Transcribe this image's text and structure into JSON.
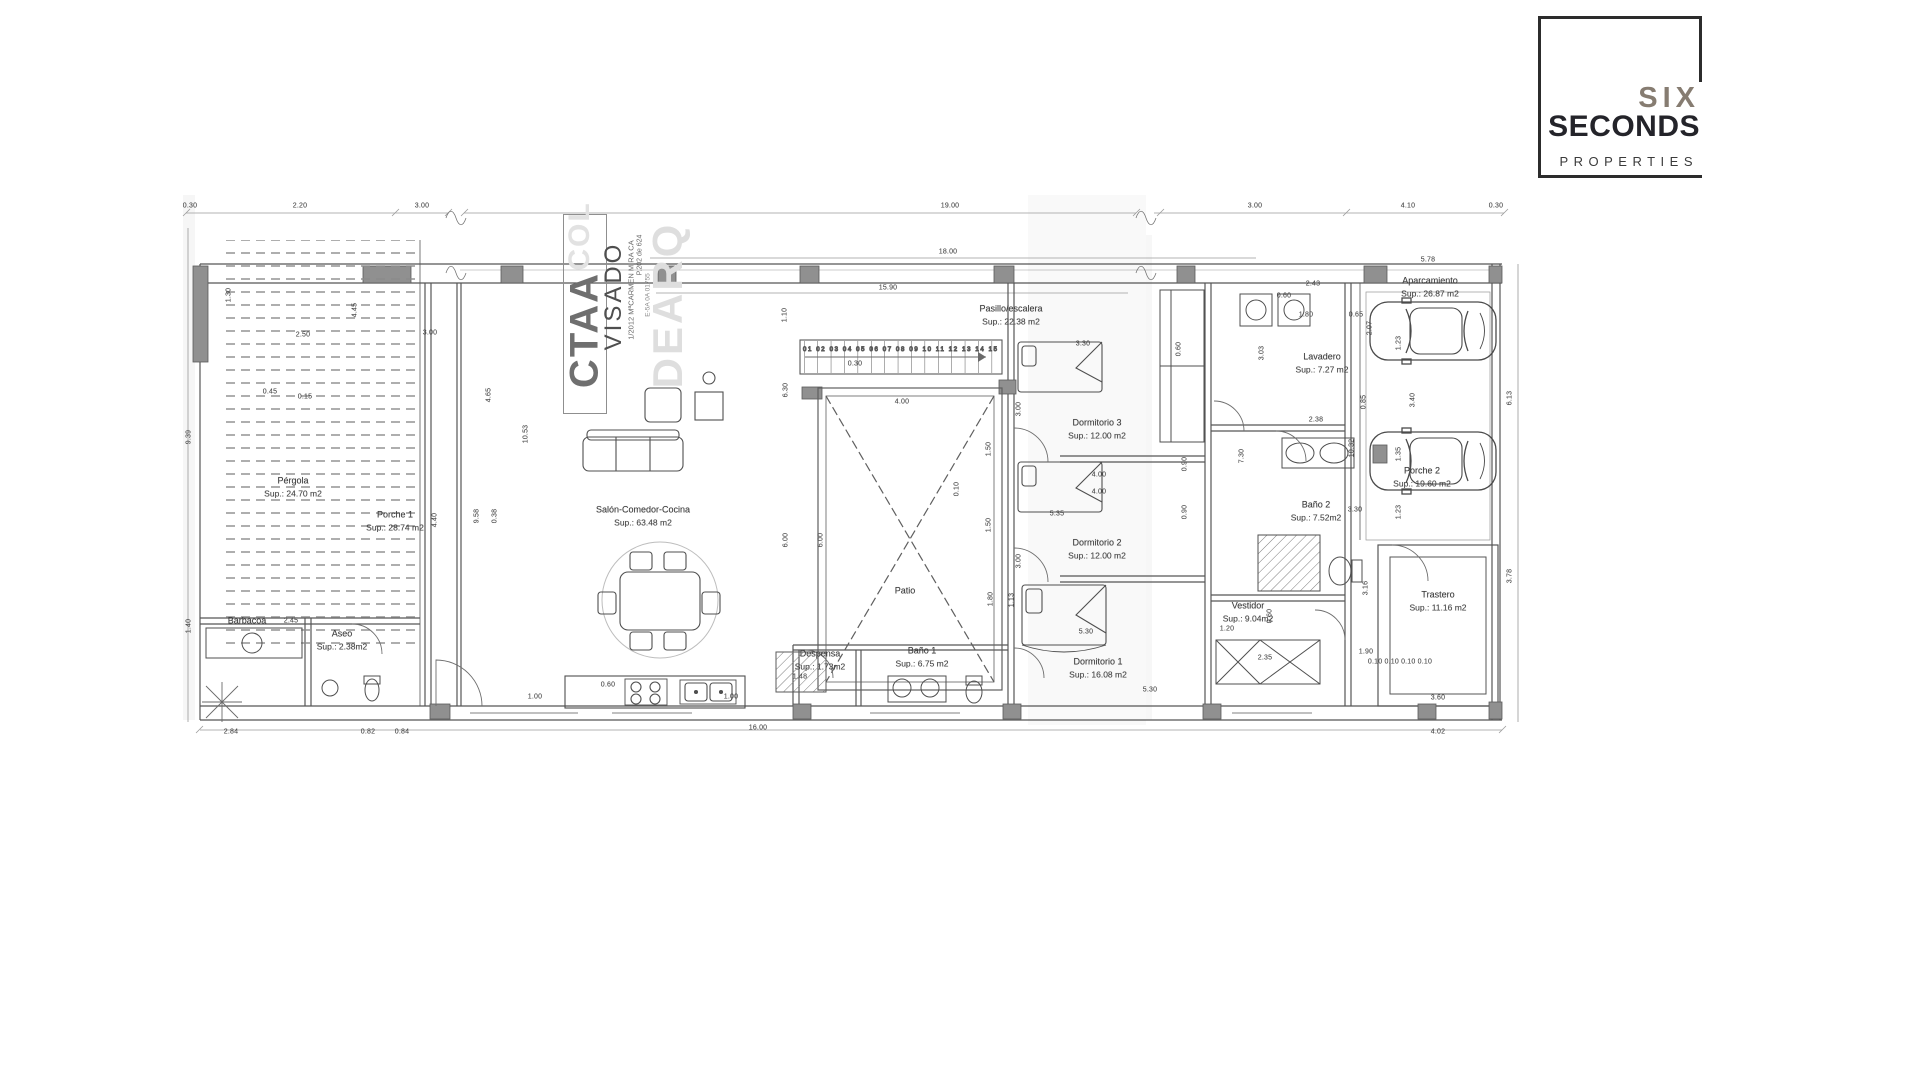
{
  "logo": {
    "six": "SIX",
    "seconds": "SECONDS",
    "properties": "PROPERTIES"
  },
  "stamp": {
    "org": "CTAA",
    "status": "VISADO",
    "small1": "1/2012 MªCARMEN MIRA CA",
    "small2": "P.202 de 624",
    "small3": "E-5A 0A 01755",
    "wm1": "COL",
    "wm2": "DEARQ"
  },
  "stairs": {
    "treads": "01 02 03 04 05 06 07 08 09 10 11 12 13 14 15"
  },
  "rooms": [
    {
      "n": "Pérgola",
      "a": "Sup.: 24.70 m2",
      "x": 293,
      "y": 487
    },
    {
      "n": "Porche 1",
      "a": "Sup.: 28.74 m2",
      "x": 395,
      "y": 521
    },
    {
      "n": "Salón-Comedor-Cocina",
      "a": "Sup.: 63.48 m2",
      "x": 643,
      "y": 516
    },
    {
      "n": "Patio",
      "a": "",
      "x": 905,
      "y": 591
    },
    {
      "n": "Pasillo/escalera",
      "a": "Sup.: 22.38 m2",
      "x": 1011,
      "y": 315
    },
    {
      "n": "Dormitorio 3",
      "a": "Sup.: 12.00 m2",
      "x": 1097,
      "y": 429
    },
    {
      "n": "Dormitorio 2",
      "a": "Sup.: 12.00 m2",
      "x": 1097,
      "y": 549
    },
    {
      "n": "Dormitorio 1",
      "a": "Sup.: 16.08 m2",
      "x": 1098,
      "y": 668
    },
    {
      "n": "Despensa",
      "a": "Sup.: 1.73m2",
      "x": 820,
      "y": 660
    },
    {
      "n": "Baño 1",
      "a": "Sup.: 6.75 m2",
      "x": 922,
      "y": 657
    },
    {
      "n": "Baño 2",
      "a": "Sup.: 7.52m2",
      "x": 1316,
      "y": 511
    },
    {
      "n": "Lavadero",
      "a": "Sup.: 7.27 m2",
      "x": 1322,
      "y": 363
    },
    {
      "n": "Vestidor",
      "a": "Sup.: 9.04m2",
      "x": 1248,
      "y": 612
    },
    {
      "n": "Porche 2",
      "a": "Sup.: 19.60 m2",
      "x": 1422,
      "y": 477
    },
    {
      "n": "Aparcamiento",
      "a": "Sup.: 26.87 m2",
      "x": 1430,
      "y": 287
    },
    {
      "n": "Trastero",
      "a": "Sup.: 11.16 m2",
      "x": 1438,
      "y": 601
    },
    {
      "n": "Barbacoa",
      "a": "",
      "x": 247,
      "y": 621
    },
    {
      "n": "Aseo",
      "a": "Sup.: 2.38m2",
      "x": 342,
      "y": 640
    }
  ],
  "dims": [
    {
      "t": "0.30",
      "x": 190,
      "y": 206
    },
    {
      "t": "2.20",
      "x": 300,
      "y": 206
    },
    {
      "t": "3.00",
      "x": 422,
      "y": 206
    },
    {
      "t": "19.00",
      "x": 950,
      "y": 206
    },
    {
      "t": "3.00",
      "x": 1255,
      "y": 206
    },
    {
      "t": "4.10",
      "x": 1408,
      "y": 206
    },
    {
      "t": "0.30",
      "x": 1496,
      "y": 206
    },
    {
      "t": "18.00",
      "x": 948,
      "y": 252
    },
    {
      "t": "15.90",
      "x": 888,
      "y": 288
    },
    {
      "t": "2.43",
      "x": 1313,
      "y": 284
    },
    {
      "t": "0.60",
      "x": 1284,
      "y": 296
    },
    {
      "t": "1.80",
      "x": 1306,
      "y": 315
    },
    {
      "t": "0.65",
      "x": 1356,
      "y": 315
    },
    {
      "t": "2.07",
      "x": 1370,
      "y": 328,
      "r": 1
    },
    {
      "t": "3.03",
      "x": 1262,
      "y": 353,
      "r": 1
    },
    {
      "t": "2.38",
      "x": 1316,
      "y": 420
    },
    {
      "t": "0.85",
      "x": 1364,
      "y": 402,
      "r": 1
    },
    {
      "t": "3.30",
      "x": 1355,
      "y": 510
    },
    {
      "t": "1.23",
      "x": 1399,
      "y": 343,
      "r": 1
    },
    {
      "t": "3.40",
      "x": 1413,
      "y": 400,
      "r": 1
    },
    {
      "t": "1.35",
      "x": 1399,
      "y": 454,
      "r": 1
    },
    {
      "t": "1.23",
      "x": 1399,
      "y": 512,
      "r": 1
    },
    {
      "t": "1.30",
      "x": 229,
      "y": 295,
      "r": 1
    },
    {
      "t": "9.39",
      "x": 189,
      "y": 437,
      "r": 1
    },
    {
      "t": "1.40",
      "x": 189,
      "y": 626,
      "r": 1
    },
    {
      "t": "2.50",
      "x": 303,
      "y": 335
    },
    {
      "t": "3.00",
      "x": 430,
      "y": 333
    },
    {
      "t": "0.45",
      "x": 270,
      "y": 392
    },
    {
      "t": "0.15",
      "x": 305,
      "y": 397
    },
    {
      "t": "4.45",
      "x": 355,
      "y": 310,
      "r": 1
    },
    {
      "t": "4.65",
      "x": 489,
      "y": 395,
      "r": 1
    },
    {
      "t": "10.53",
      "x": 526,
      "y": 434,
      "r": 1
    },
    {
      "t": "9.58",
      "x": 477,
      "y": 516,
      "r": 1
    },
    {
      "t": "0.38",
      "x": 495,
      "y": 516,
      "r": 1
    },
    {
      "t": "4.40",
      "x": 435,
      "y": 520,
      "r": 1
    },
    {
      "t": "1.10",
      "x": 785,
      "y": 315,
      "r": 1
    },
    {
      "t": "0.30",
      "x": 855,
      "y": 364
    },
    {
      "t": "4.00",
      "x": 902,
      "y": 402
    },
    {
      "t": "6.30",
      "x": 786,
      "y": 390,
      "r": 1
    },
    {
      "t": "6.00",
      "x": 786,
      "y": 540,
      "r": 1
    },
    {
      "t": "6.00",
      "x": 821,
      "y": 540,
      "r": 1
    },
    {
      "t": "0.10",
      "x": 957,
      "y": 489,
      "r": 1
    },
    {
      "t": "3.00",
      "x": 1019,
      "y": 409,
      "r": 1
    },
    {
      "t": "1.50",
      "x": 989,
      "y": 449,
      "r": 1
    },
    {
      "t": "1.50",
      "x": 989,
      "y": 525,
      "r": 1
    },
    {
      "t": "3.00",
      "x": 1019,
      "y": 561,
      "r": 1
    },
    {
      "t": "1.80",
      "x": 991,
      "y": 599,
      "r": 1
    },
    {
      "t": "3.30",
      "x": 1083,
      "y": 344
    },
    {
      "t": "0.60",
      "x": 1179,
      "y": 349,
      "r": 1
    },
    {
      "t": "4.00",
      "x": 1099,
      "y": 475
    },
    {
      "t": "4.00",
      "x": 1099,
      "y": 492
    },
    {
      "t": "0.90",
      "x": 1185,
      "y": 464,
      "r": 1
    },
    {
      "t": "0.90",
      "x": 1185,
      "y": 512,
      "r": 1
    },
    {
      "t": "7.30",
      "x": 1242,
      "y": 456,
      "r": 1
    },
    {
      "t": "5.30",
      "x": 1086,
      "y": 632
    },
    {
      "t": "5.30",
      "x": 1150,
      "y": 690
    },
    {
      "t": "1.20",
      "x": 1227,
      "y": 629
    },
    {
      "t": "0.60",
      "x": 1270,
      "y": 616,
      "r": 1
    },
    {
      "t": "1.13",
      "x": 1012,
      "y": 600,
      "r": 1
    },
    {
      "t": "5.35",
      "x": 1057,
      "y": 514
    },
    {
      "t": "1.00",
      "x": 535,
      "y": 697
    },
    {
      "t": "0.60",
      "x": 608,
      "y": 685
    },
    {
      "t": "1.00",
      "x": 731,
      "y": 697
    },
    {
      "t": "1.48",
      "x": 800,
      "y": 677
    },
    {
      "t": "16.00",
      "x": 758,
      "y": 728
    },
    {
      "t": "2.84",
      "x": 231,
      "y": 732
    },
    {
      "t": "0.82",
      "x": 368,
      "y": 732
    },
    {
      "t": "0.84",
      "x": 402,
      "y": 732
    },
    {
      "t": "2.45",
      "x": 291,
      "y": 621
    },
    {
      "t": "1.90",
      "x": 1366,
      "y": 652
    },
    {
      "t": "0.10 0.10 0.10 0.10",
      "x": 1400,
      "y": 662
    },
    {
      "t": "3.60",
      "x": 1438,
      "y": 698
    },
    {
      "t": "4.02",
      "x": 1438,
      "y": 732
    },
    {
      "t": "3.16",
      "x": 1366,
      "y": 588,
      "r": 1
    },
    {
      "t": "6.13",
      "x": 1510,
      "y": 398,
      "r": 1
    },
    {
      "t": "3.78",
      "x": 1510,
      "y": 576,
      "r": 1
    },
    {
      "t": "10.32",
      "x": 1352,
      "y": 448,
      "r": 1
    },
    {
      "t": "5.78",
      "x": 1428,
      "y": 260
    },
    {
      "t": "2.35",
      "x": 1265,
      "y": 658
    }
  ]
}
